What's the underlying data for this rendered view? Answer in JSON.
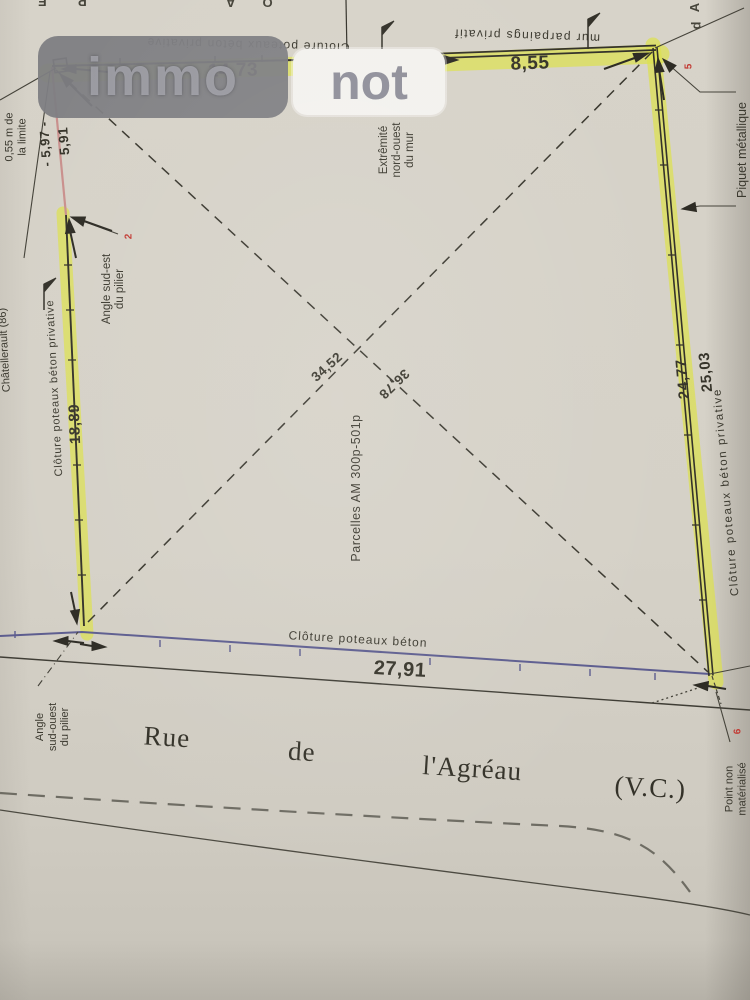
{
  "watermark": {
    "immo": "immo",
    "not": "not"
  },
  "colors": {
    "highlight": "#dde14f",
    "fence_purple": "#5d5d8f",
    "marker_red": "#c23b34",
    "pink_line": "#c9908d",
    "ink": "#3b392f",
    "paper": "#d5d1c7"
  },
  "fragments": {
    "top_left": "P E",
    "top_mid": "O A",
    "tr1": "A",
    "tr2": "d"
  },
  "north_fence": {
    "label": "Clôture poteaux béton privative",
    "length": "14,73"
  },
  "north_wall": {
    "label": "mur parpaings privatif",
    "length": "8,55"
  },
  "wall_note": {
    "line1": "Extrêmité",
    "line2": "nord-ouest",
    "line3": "du mur",
    "marker": "4"
  },
  "offset_note": {
    "line1": "0,55 m de",
    "line2": "la limite",
    "d1": "- 5,97 -",
    "d2": "5,91"
  },
  "pillar_se_note": {
    "line1": "Angle sud-est",
    "line2": "du pilier",
    "marker": "2"
  },
  "city_label": "Châtellerault (86)",
  "west_fence": {
    "label": "Clôture poteaux béton privative",
    "length": "18,89"
  },
  "east_fence": {
    "label": "Clôture poteaux béton privative",
    "length1": "24,77",
    "length2": "25,03"
  },
  "piquet_note": {
    "label": "Piquet métallique",
    "marker": "5"
  },
  "diagonals": {
    "d1": "34,52",
    "d2": "36,78"
  },
  "parcel": {
    "label": "Parcelles AM 300p-501p"
  },
  "south_fence": {
    "label": "Clôture poteaux béton",
    "length": "27,91"
  },
  "pillar_sw_note": {
    "line1": "Angle",
    "line2": "sud-ouest",
    "line3": "du pilier"
  },
  "point_note": {
    "line1": "Point non",
    "line2": "matérialisé",
    "marker": "6"
  },
  "street": {
    "w1": "Rue",
    "w2": "de",
    "w3": "l'Agréau",
    "w4": "(V.C.)"
  }
}
